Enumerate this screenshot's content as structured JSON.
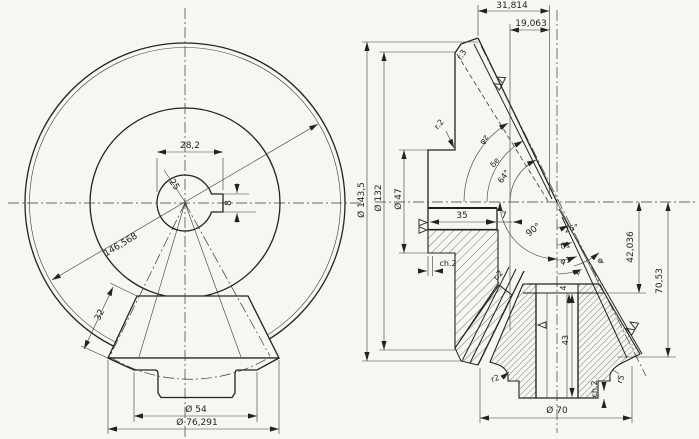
{
  "drawing": {
    "type": "technical-drawing",
    "paper_color": "#f7f6f1",
    "ink_color": "#24241f",
    "left_view": {
      "dims": {
        "d28_2": "28,2",
        "d8": "8",
        "d25": "25",
        "d146_568": "146,568",
        "d32": "32",
        "d54": "Ø  54",
        "d76_291": "Ø  76,291"
      }
    },
    "right_view": {
      "dims": {
        "d31_814": "31,814",
        "d19_063": "19,063",
        "d143_5": "Ø 143,5",
        "d132": "Ø 132",
        "d47": "Ø 47",
        "d35": "35",
        "d7": "7",
        "ch2_flange": "ch.2",
        "ch2_bore": "ch.2",
        "d42_036": "42,036",
        "d70_53": "70,53",
        "d70": "Ø  70",
        "d43": "43",
        "d4": "4",
        "r3": "r.3",
        "r2_top": "r.2",
        "r2_mid": "r.2",
        "r2_bottom": "r2",
        "r5": "r5"
      },
      "angles": {
        "a90": "90°",
        "a26": "26°",
        "a64": "64°",
        "phi_z": "φz",
        "delta_e": "δe",
        "delta_1": "δ1",
        "phi_1": "φ1",
        "psi": "ψ",
        "phi": "φ"
      }
    }
  }
}
